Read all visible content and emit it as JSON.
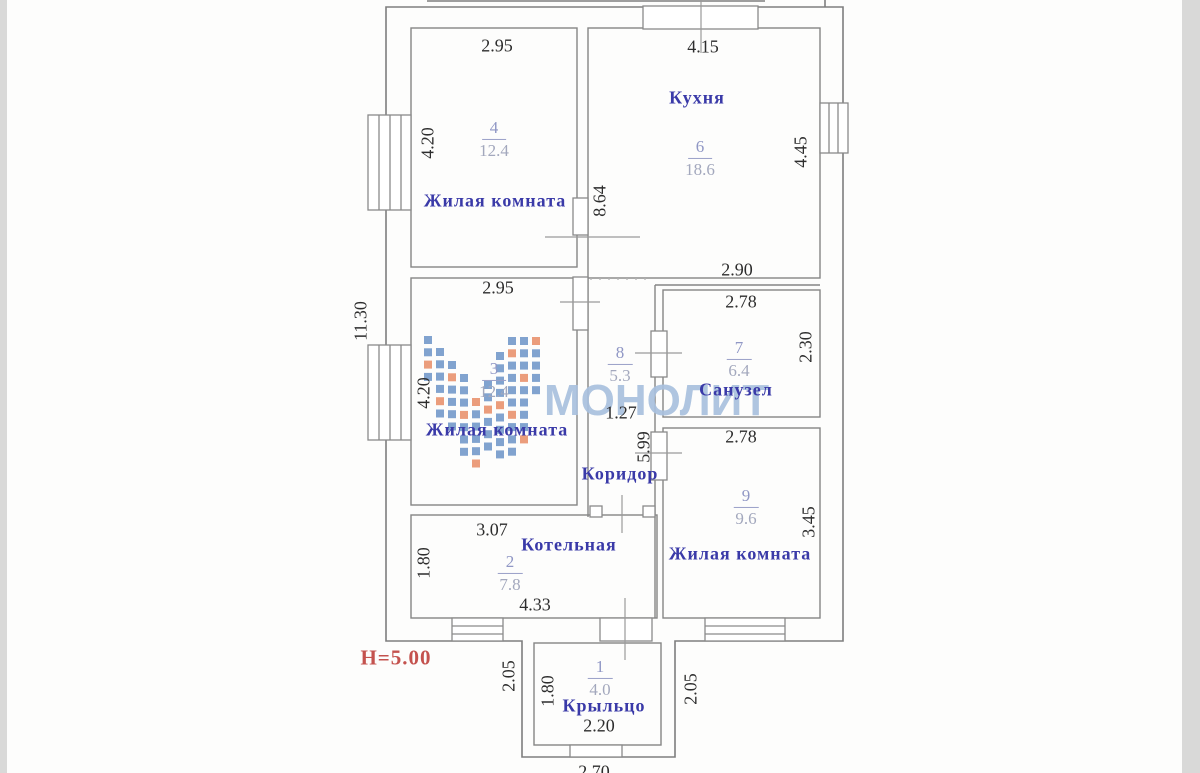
{
  "watermark": {
    "text": "МОНОЛИТ",
    "color": "#a9c1de",
    "logo_blue": "#7096c8",
    "logo_orange": "#e8906a"
  },
  "height_note": "H=5.00",
  "colors": {
    "room_label_blue": "#3a3aa8",
    "dimension_text": "#2d2d2d",
    "room_stat_lavender": "#9097c5",
    "note_red": "#c4524e",
    "line_gray": "#858585"
  },
  "rooms": {
    "living1": {
      "num": "4",
      "area": "12.4",
      "label": "Жилая комната"
    },
    "kitchen": {
      "num": "6",
      "area": "18.6",
      "label": "Кухня"
    },
    "living2": {
      "num": "3",
      "area": "12.4",
      "label": "Жилая комната"
    },
    "corridor": {
      "num": "8",
      "area": "5.3",
      "label": "Коридор"
    },
    "bathroom": {
      "num": "7",
      "area": "6.4",
      "label": "Санузел"
    },
    "living3": {
      "num": "9",
      "area": "9.6",
      "label": "Жилая комната"
    },
    "boiler": {
      "num": "2",
      "area": "7.8",
      "label": "Котельная"
    },
    "porch": {
      "num": "1",
      "area": "4.0",
      "label": "Крыльцо"
    }
  },
  "dims": {
    "room4_top": "2.95",
    "kitchen_top": "4.15",
    "room4_left": "4.20",
    "kitchen_right": "4.45",
    "inner_wall": "8.64",
    "left_total": "11.30",
    "room3_top": "2.95",
    "room3_left": "4.20",
    "kitchen_bottom": "2.90",
    "bath_top": "2.78",
    "bath_right": "2.30",
    "corridor_w": "1.27",
    "corridor_h": "5.99",
    "room9_top": "2.78",
    "room9_right": "3.45",
    "boiler_top": "3.07",
    "boiler_left": "1.80",
    "boiler_bottom": "4.33",
    "porch_gap_left": "2.05",
    "porch_gap_right": "2.05",
    "porch_left": "1.80",
    "porch_inner": "2.20",
    "porch_outer": "2.70"
  }
}
